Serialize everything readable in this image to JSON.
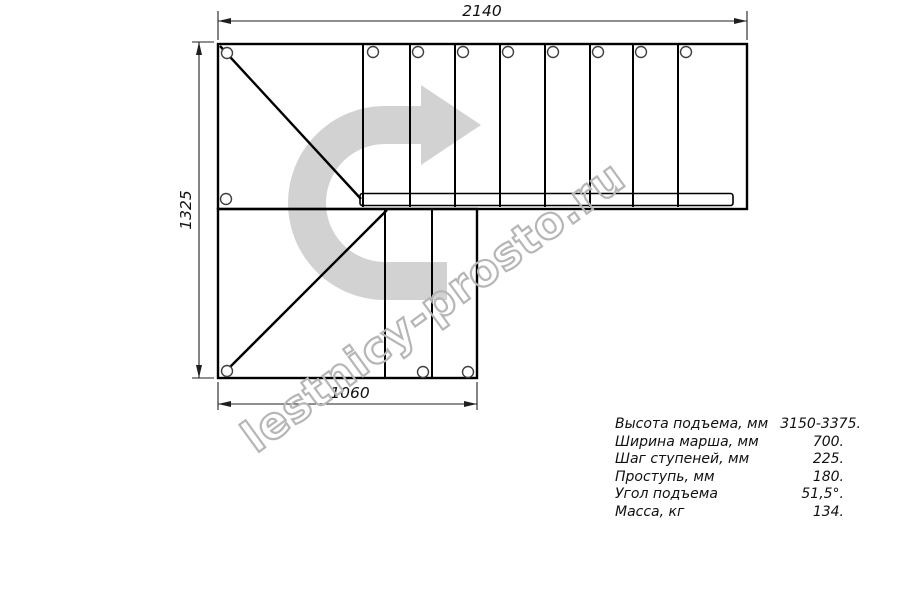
{
  "watermark": {
    "text": "lestnicy-prosto.ru",
    "arrow_color": "#d2d2d2",
    "outline_color": "#b6b6b6"
  },
  "dimensions": {
    "top_width": "2140",
    "left_height": "1325",
    "bottom_width": "1060"
  },
  "specs": {
    "rows": [
      {
        "label": "Высота подъема, мм",
        "value": "3150-3375."
      },
      {
        "label": "Ширина марша, мм",
        "value": "700."
      },
      {
        "label": "Шаг ступеней, мм",
        "value": "225."
      },
      {
        "label": "Проступь, мм",
        "value": "180."
      },
      {
        "label": "Угол подъема",
        "value": "51,5°."
      },
      {
        "label": "Масса, кг",
        "value": "134."
      }
    ]
  },
  "colors": {
    "drawing_line": "#000000",
    "dimension_line": "#1f1f1f",
    "hole_outline": "#404040"
  }
}
